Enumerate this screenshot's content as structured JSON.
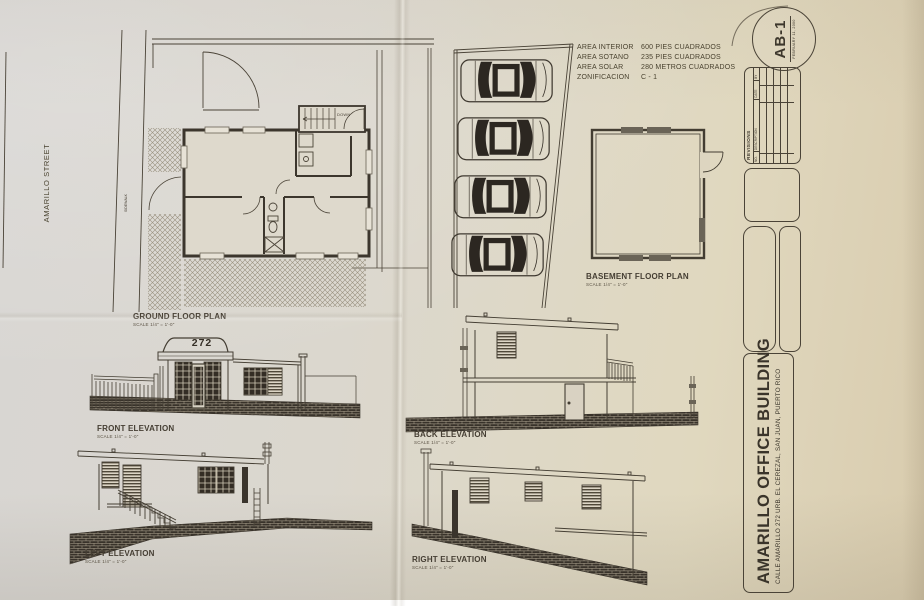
{
  "sheet": {
    "number": "AB-1",
    "date": "FEBRUARY 11, 2000",
    "title": "AMARILLO OFFICE BUILDING",
    "address": "CALLE AMARILLO 272 URB. EL CEREZAL, SAN JUAN, PUERTO RICO"
  },
  "revisions": {
    "title": "REVISIONS",
    "col_no": "NO.",
    "col_description": "DESCRIPTION",
    "col_date": "DATE",
    "col_by": "BY"
  },
  "site_info": {
    "rows": [
      {
        "label": "AREA INTERIOR",
        "value": "600 PIES CUADRADOS"
      },
      {
        "label": "AREA SOTANO",
        "value": "235 PIES CUADRADOS"
      },
      {
        "label": "AREA SOLAR",
        "value": "280 METROS CUADRADOS"
      },
      {
        "label": "ZONIFICACION",
        "value": "C - 1"
      }
    ]
  },
  "site_plan": {
    "street": "AMARILLO STREET",
    "sidewalk": "SIDEWALK",
    "stairs_direction": "DOWN",
    "house_number": "272",
    "parking_spaces": 4
  },
  "drawings": {
    "ground_floor": {
      "title": "GROUND FLOOR PLAN",
      "scale": "SCALE 1/4\" = 1'-0\""
    },
    "basement": {
      "title": "BASEMENT FLOOR PLAN",
      "scale": "SCALE 1/4\" = 1'-0\""
    },
    "front": {
      "title": "FRONT ELEVATION",
      "scale": "SCALE 1/4\" = 1'-0\""
    },
    "back": {
      "title": "BACK ELEVATION",
      "scale": "SCALE 1/4\" = 1'-0\""
    },
    "left": {
      "title": "LEFT ELEVATION",
      "scale": "SCALE 1/4\" = 1'-0\""
    },
    "right": {
      "title": "RIGHT ELEVATION",
      "scale": "SCALE 1/4\" = 1'-0\""
    }
  }
}
